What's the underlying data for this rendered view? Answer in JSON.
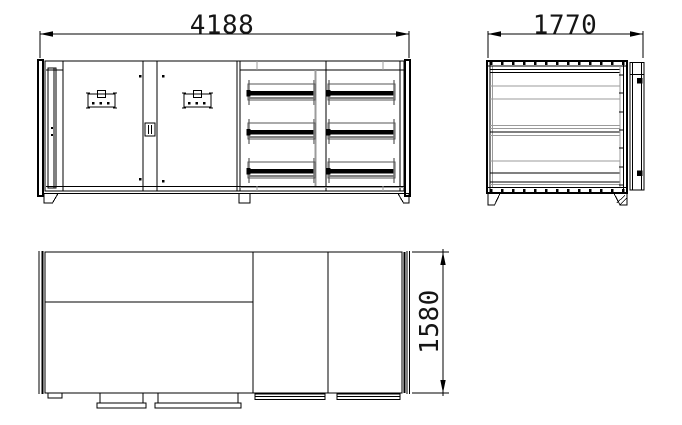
{
  "drawing": {
    "kind": "three-view technical drawing",
    "views": {
      "front": {
        "name": "front-view",
        "dim_width": "4188"
      },
      "side": {
        "name": "side-view",
        "dim_width": "1770"
      },
      "plan": {
        "name": "plan-view",
        "dim_depth": "1580"
      }
    },
    "colors": {
      "line": "#000000",
      "auxiliary_line": "#9b9b9b",
      "background": "#ffffff",
      "dimension_text": "#161616"
    }
  }
}
